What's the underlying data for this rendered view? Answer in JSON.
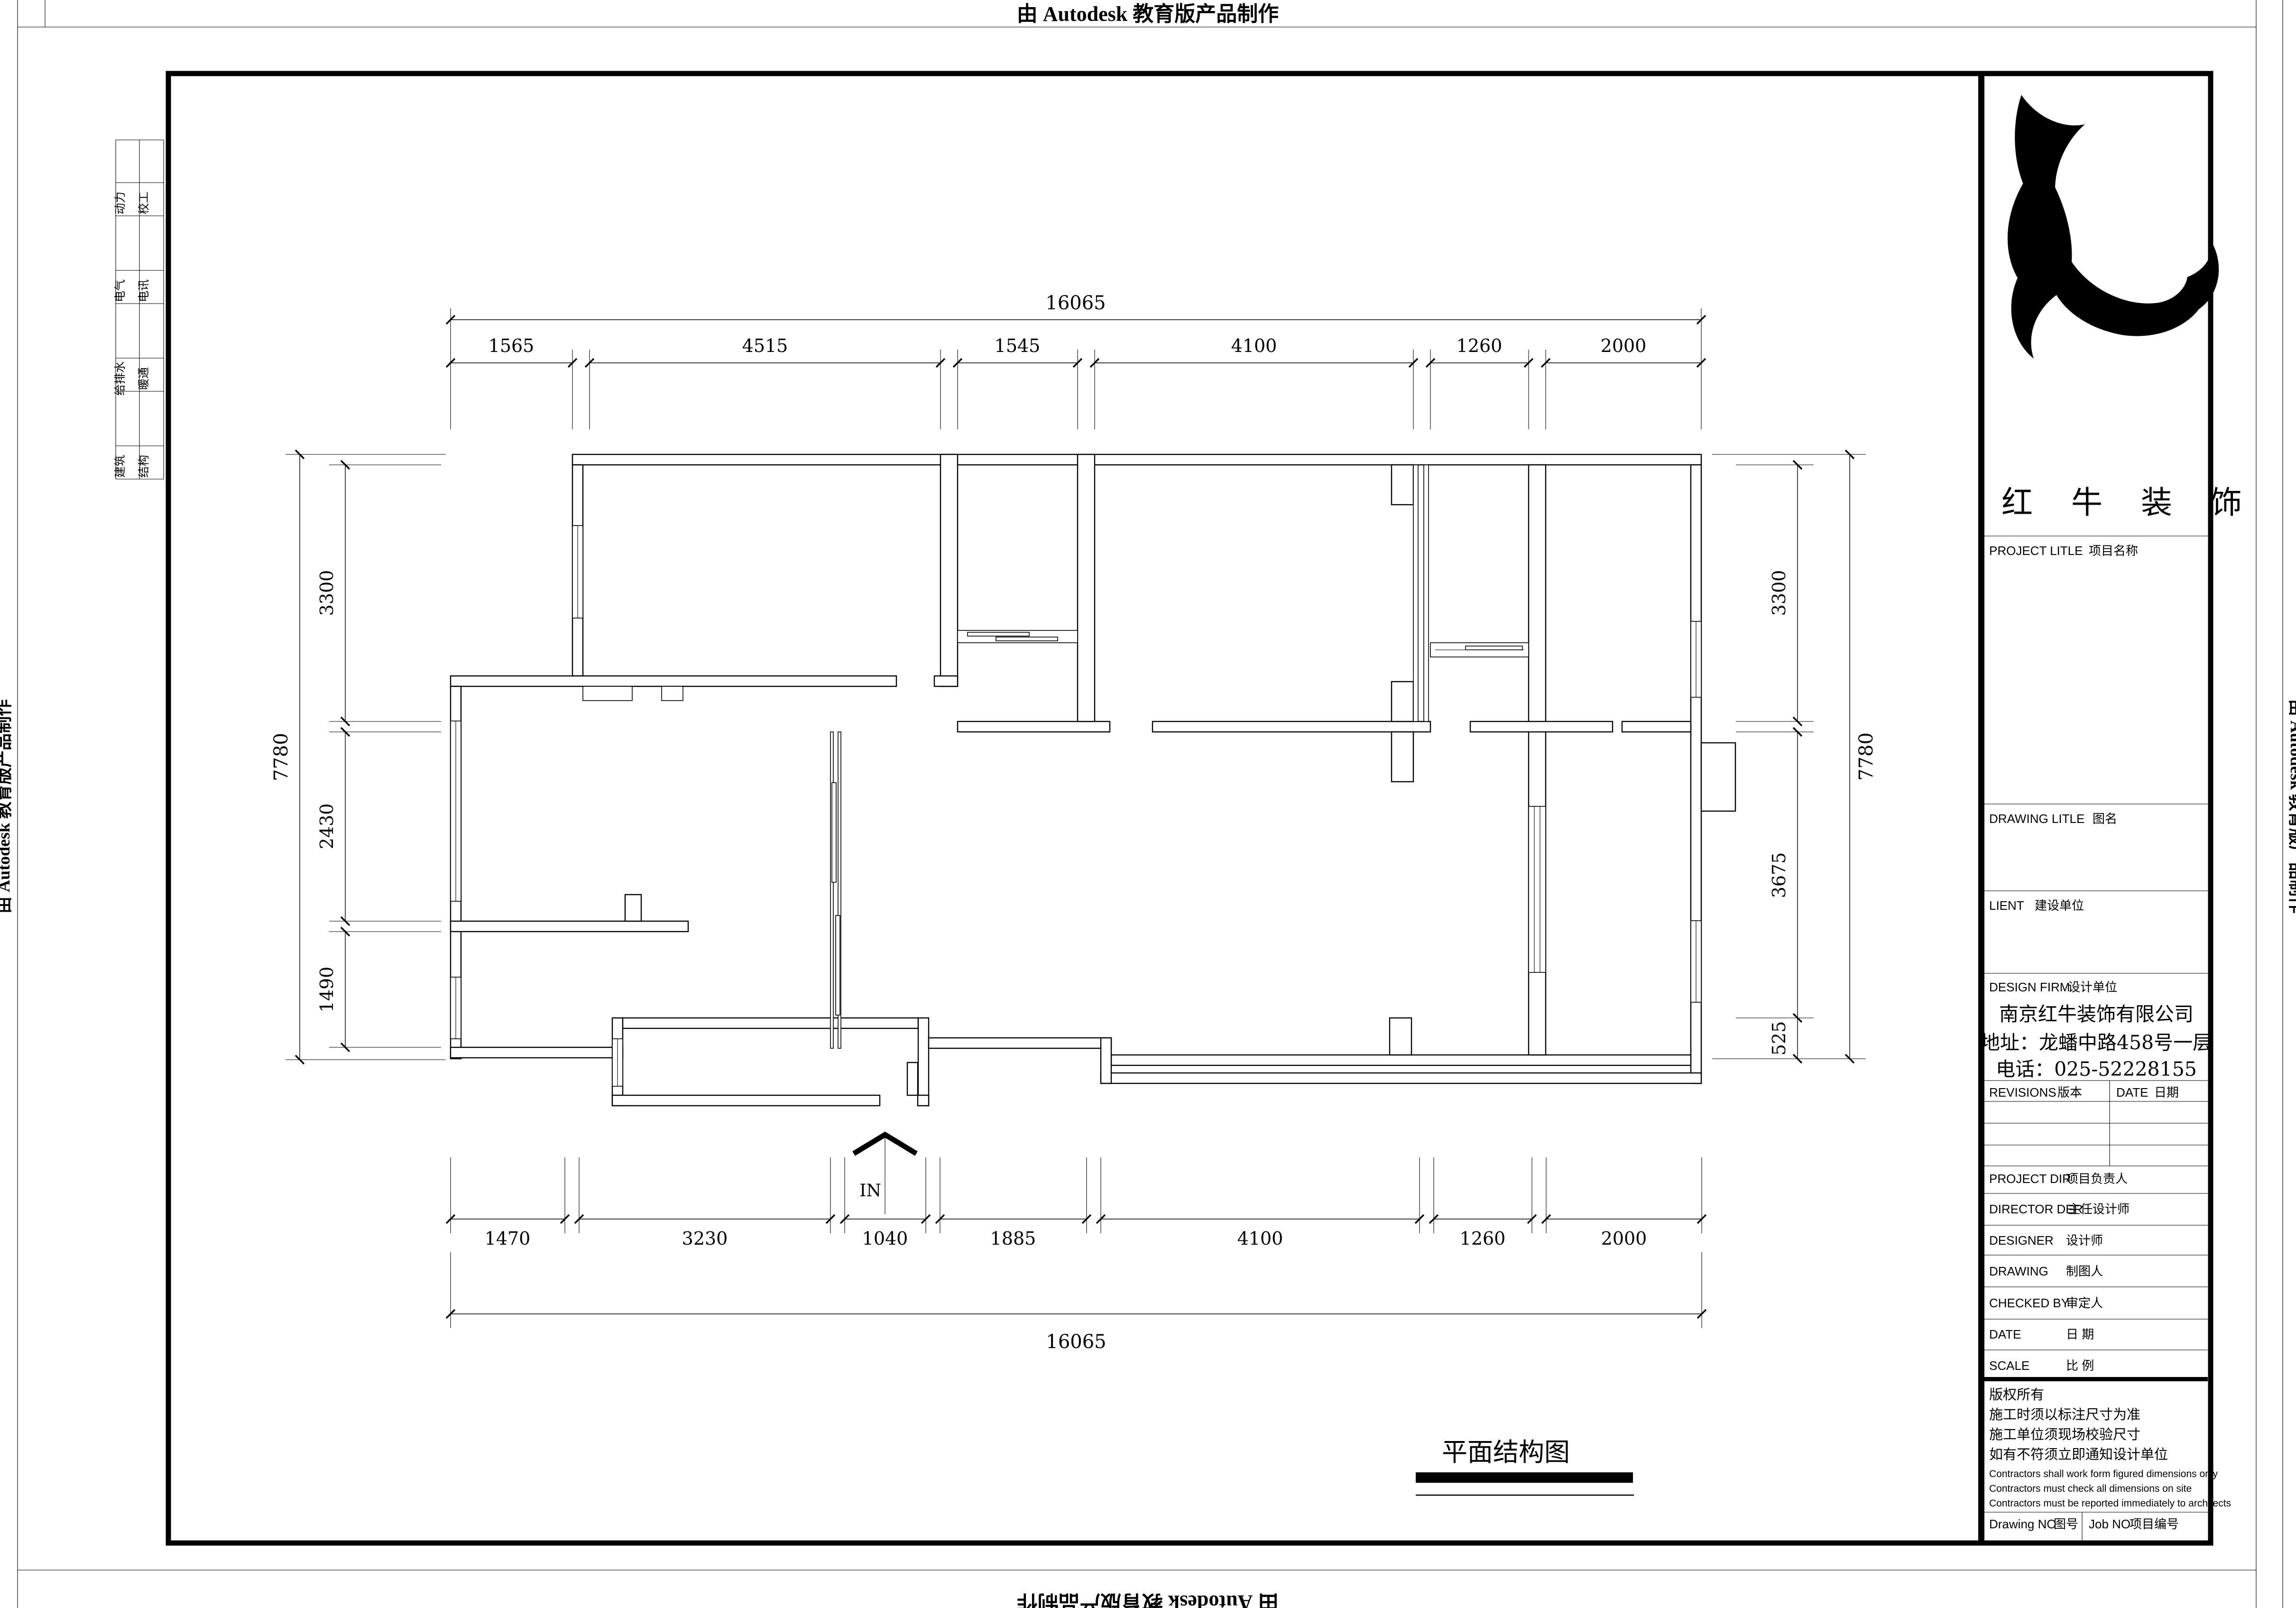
{
  "banner": {
    "text": "由 Autodesk 教育版产品制作"
  },
  "margin_strip": {
    "rows": [
      {
        "c1": "动力",
        "c2": "校工"
      },
      {
        "c1": "电气",
        "c2": "电讯"
      },
      {
        "c1": "给排水",
        "c2": "暖通"
      },
      {
        "c1": "建筑",
        "c2": "结构"
      }
    ]
  },
  "title_block": {
    "brand": "红 牛 装 饰",
    "sections": [
      {
        "en": "PROJECT LITLE",
        "zh": "项目名称"
      },
      {
        "en": "DRAWING LITLE",
        "zh": "图名"
      },
      {
        "en": "LIENT",
        "zh": "建设单位"
      },
      {
        "en": "DESIGN FIRM",
        "zh": "设计单位"
      }
    ],
    "revisions": {
      "en": "REVISIONS",
      "zh": "版本"
    },
    "date_col": {
      "en": "DATE",
      "zh": "日期"
    },
    "rows": [
      {
        "en": "PROJECT DIR",
        "zh": "项目负责人"
      },
      {
        "en": "DIRECTOR DER",
        "zh": "主任设计师"
      },
      {
        "en": "DESIGNER",
        "zh": "设计师"
      },
      {
        "en": "DRAWING",
        "zh": "制图人"
      },
      {
        "en": "CHECKED BY",
        "zh": "审定人"
      },
      {
        "en": "DATE",
        "zh": "日 期"
      },
      {
        "en": "SCALE",
        "zh": "比 例"
      }
    ],
    "company": {
      "name": "南京红牛装饰有限公司",
      "address": "地址：龙蟠中路458号一层",
      "phone": "电话：025-52228155"
    },
    "copyright": [
      "版权所有",
      "施工时须以标注尺寸为准",
      "施工单位须现场校验尺寸",
      "如有不符须立即通知设计单位"
    ],
    "disclaimer": [
      "Contractors shall work form figured dimensions only",
      "Contractors must check all dimensions on site",
      "Contractors must be reported immediately to architects"
    ],
    "footer": {
      "drawing_no_en": "Drawing NO",
      "drawing_no_zh": "图号",
      "job_no_en": "Job NO",
      "job_no_zh": "项目编号"
    }
  },
  "plan": {
    "title": "平面结构图",
    "entrance": "IN",
    "dims": {
      "top_total": "16065",
      "top": [
        "1565",
        "4515",
        "1545",
        "4100",
        "1260",
        "2000"
      ],
      "bottom": [
        "1470",
        "3230",
        "1040",
        "1885",
        "4100",
        "1260",
        "2000"
      ],
      "bottom_total": "16065",
      "left": [
        "3300",
        "2430",
        "1490"
      ],
      "left_total": "7780",
      "right": [
        "3300",
        "3675",
        "525"
      ],
      "right_total": "7780"
    }
  }
}
